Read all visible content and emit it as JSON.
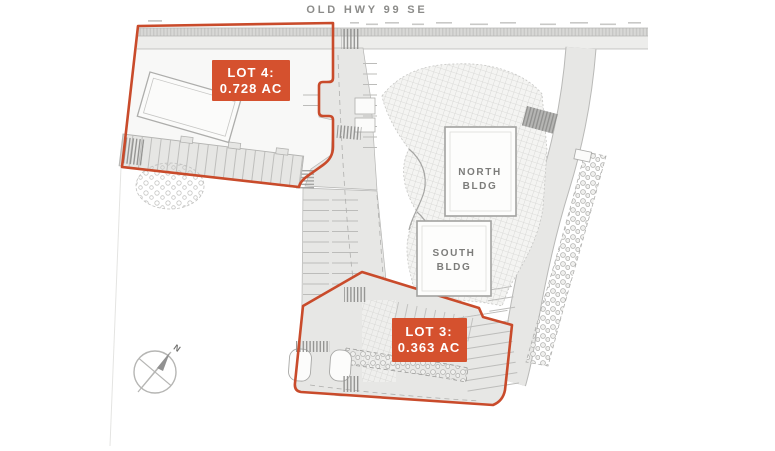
{
  "map": {
    "road_name": "OLD HWY 99 SE",
    "lots": {
      "lot4": {
        "name": "LOT 4:",
        "area": "0.728 AC"
      },
      "lot3": {
        "name": "LOT 3:",
        "area": "0.363 AC"
      }
    },
    "buildings": {
      "north": {
        "line1": "NORTH",
        "line2": "BLDG"
      },
      "south": {
        "line1": "SOUTH",
        "line2": "BLDG"
      }
    },
    "compass": {
      "label": "N"
    },
    "colors": {
      "boundary_red": "#c94b2b",
      "label_box_fill": "#d5512e",
      "label_text": "#ffffff",
      "pavement_gray": "#e7e7e5",
      "outline_gray": "#b3b3b1",
      "road_name_text": "#8c8c8a",
      "building_text": "#7c7c7a",
      "page_background": "#ffffff"
    }
  }
}
